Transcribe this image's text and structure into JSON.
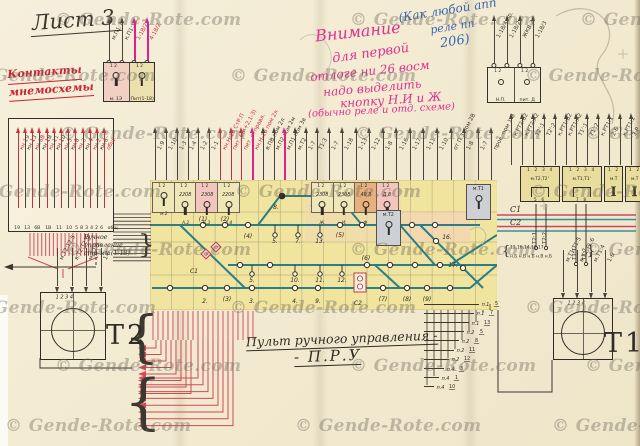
{
  "watermark": {
    "text": "© Gende-Rote.com",
    "color": "#6e6860"
  },
  "sheet": {
    "title": "Лист 3"
  },
  "colors": {
    "paper": "#f3ebd2",
    "ink": "#2f2b26",
    "red_ink": "#cc2232",
    "magenta_pen": "#e0308f",
    "blue_pen": "#3a66b5",
    "panel_yellow": "#f0e49e",
    "track_teal": "#2b7e85",
    "wire_red": "#cf4a58"
  },
  "notes": {
    "red_label_line1": "Контакты",
    "red_label_line2": "мнемосхемы",
    "blue_1": "(Как любой апп",
    "blue_2": "реле пп",
    "blue_3": "206)",
    "magenta_1": "Внимание",
    "magenta_2": "для первой",
    "magenta_3": "отлоге ни 26 восм",
    "magenta_4": "надо выделить",
    "magenta_5": "кнопку Н.И и Ж",
    "magenta_6": "(обычно реле и отд. схеме)",
    "caption_left": "Ручное управление стр-ми (1-18)",
    "title_main": "Пульт ручного управления -",
    "title_abbr": "- П.Р.У"
  },
  "top_left_box": {
    "cells": [
      {
        "label": "м. 1Э"
      },
      {
        "label": "Пит(1-18)"
      }
    ],
    "pins": "1   2",
    "wires": [
      {
        "label": "м.П1:7"
      },
      {
        "label": "к.П1:13"
      },
      {
        "label": "1-18/2",
        "red": true,
        "hot": true
      },
      {
        "label": "4-18/2",
        "red": true,
        "hot": true
      }
    ]
  },
  "np_box": {
    "cells": [
      {
        "label": "Н.П."
      },
      {
        "label": "пит. Д"
      }
    ],
    "pins": "1   2",
    "wires": [
      {
        "label": "1-18/4 пр."
      },
      {
        "label": "1-18/2"
      },
      {
        "label": "ЖКВ:2"
      },
      {
        "label": "1-18/3"
      }
    ]
  },
  "left_block": {
    "wires": [
      {
        "label": "кн.19",
        "red": true
      },
      {
        "label": "кн.13"
      },
      {
        "label": "кн.6В",
        "red": true
      },
      {
        "label": "кн.1В"
      },
      {
        "label": "кн.11",
        "red": true
      },
      {
        "label": "кн.10"
      },
      {
        "label": "кн.5",
        "red": true
      },
      {
        "label": "кн.8"
      },
      {
        "label": "кн.3",
        "red": true
      },
      {
        "label": "кн.4"
      },
      {
        "label": "кн.2",
        "red": true
      },
      {
        "label": "кн.6"
      },
      {
        "label": "общ.",
        "red": true
      }
    ],
    "pins": [
      "19",
      "13",
      "6В",
      "1В",
      "11",
      "10",
      "5",
      "8",
      "3",
      "4",
      "2",
      "6",
      "общ"
    ]
  },
  "panel_wires_left": [
    {
      "label": "1-9"
    },
    {
      "label": "1-10"
    },
    {
      "label": "1-3"
    },
    {
      "label": "1-4"
    },
    {
      "label": "1-2"
    },
    {
      "label": "1-1"
    },
    {
      "label": "кн.Н:18 СтР.П",
      "red": true
    },
    {
      "label": "пит. 6(и+2,1-3)",
      "red": true
    },
    {
      "label": "пит. отправл.",
      "red": true
    },
    {
      "label": "кн.Н-18 пом 2л",
      "red": true,
      "hot": true
    },
    {
      "label": "в.ПВ пом 2л"
    },
    {
      "label": "м.П2 пом 2м"
    },
    {
      "label": "м.П1 пом 3в",
      "hot": true
    },
    {
      "label": "м.Т2"
    },
    {
      "label": "1-7"
    },
    {
      "label": "Т1:3"
    }
  ],
  "panel_wires_right": [
    {
      "label": "1-7"
    },
    {
      "label": "1-18"
    },
    {
      "label": "1-13"
    },
    {
      "label": "1-12"
    },
    {
      "label": "1-8"
    },
    {
      "label": "1-16"
    },
    {
      "label": "1-17"
    },
    {
      "label": "1-11"
    },
    {
      "label": "1-10"
    },
    {
      "label": "от П.3 пом 2В"
    },
    {
      "label": "1-8"
    },
    {
      "label": "1-7"
    },
    {
      "label": "пров. пом 1-В"
    }
  ],
  "right_wires": [
    {
      "label": "к.РТ2:В2"
    },
    {
      "label": "к.РТ2:А2"
    },
    {
      "label": "Т2':1"
    },
    {
      "label": "Т2':2"
    },
    {
      "label": "к.РТ1:В2"
    },
    {
      "label": "к.РТ1:А2"
    },
    {
      "label": "Т1':1"
    },
    {
      "label": "Т1':2"
    },
    {
      "label": "к.РТ1:1"
    },
    {
      "label": "2-Б"
    },
    {
      "label": "к.РТ1:2"
    },
    {
      "label": "3-Р"
    }
  ],
  "right_boxes": [
    {
      "label": "м.Т2,Т2'",
      "sym": "bracket",
      "pins_top": "1 2 3 4",
      "pins_bottom": "5 6",
      "w": 38
    },
    {
      "label": "м.Т1,Т1'",
      "sym": "bracket",
      "pins_top": "1 2 3 4",
      "pins_bottom": "7 8",
      "w": 38
    },
    {
      "label": "м.Т",
      "sym": "coil",
      "pins_top": "1 2",
      "pins_bottom": "",
      "w": 17
    },
    {
      "label": "м.Т",
      "sym": "coil",
      "pins_top": "1 2",
      "pins_bottom": "",
      "w": 17
    }
  ],
  "c_lines": {
    "c1": "С1",
    "c2": "С2",
    "v_labels": [
      "Т2:1",
      "Т2:2",
      "Т1:1",
      "Т1:2"
    ]
  },
  "terminal_bracket": {
    "top": "12,16,14,18,17",
    "bottom": "н.Б н.В н.Б н.В н.Б"
  },
  "t2": {
    "label": "Т2",
    "pins": "1   2   3   4",
    "wires": [
      {
        "label": "м.Т2:Т2:5"
      },
      {
        "label": "в.Т2:Т2:6"
      },
      {
        "label": "м.Т2:3"
      },
      {
        "label": "1-Б"
      }
    ]
  },
  "t1": {
    "label": "Т1",
    "pins": "1   2   3   4",
    "wires": [
      {
        "label": "м.Т1:Т1:5"
      },
      {
        "label": "в.Т1:Т1:6"
      },
      {
        "label": "м.Т1:4"
      },
      {
        "label": "1-Б"
      }
    ]
  },
  "ladder": [
    {
      "t": "п.1",
      "n": "5"
    },
    {
      "t": "п.1",
      "n": "7"
    },
    {
      "t": "п.1",
      "n": "13"
    },
    {
      "t": "п.2",
      "n": "5"
    },
    {
      "t": "п.2",
      "n": "8"
    },
    {
      "t": "п.2",
      "n": "11"
    },
    {
      "t": "п.2",
      "n": "12"
    },
    {
      "t": "п.4",
      "n": "3"
    },
    {
      "t": "п.4",
      "n": "1"
    },
    {
      "t": "п.4",
      "n": "10"
    }
  ],
  "panel": {
    "key_cells": [
      {
        "num": "",
        "sub": "м.2"
      },
      {
        "num": "2208",
        "sub": "А.2"
      },
      {
        "num": "2308",
        "sub": "Б.3",
        "tint": "pink"
      },
      {
        "num": "2208",
        "sub": "А.4"
      },
      {
        "num": "2308",
        "sub": "Ж."
      },
      {
        "num": "2308",
        "sub": "И."
      },
      {
        "num": "49.8",
        "sub": "Ф",
        "tint": "orange"
      },
      {
        "num": "Д.8",
        "sub": "уп.В",
        "tint": "pink"
      }
    ],
    "gray_cells": [
      {
        "label": "м.Т2"
      },
      {
        "label": "м.Т1"
      }
    ],
    "c1": "С1",
    "c2": "С2",
    "lamp_labels": [
      "(1)",
      "(2)",
      "(4)",
      "5.",
      "7.",
      "13.",
      "(5)",
      "8.",
      "14.",
      "5.",
      "10.",
      "11.",
      "12.",
      "(6)",
      "2.",
      "(3)",
      "3.",
      "4.",
      "9.",
      "(7)",
      "(8)",
      "(9)",
      "16.",
      "17."
    ]
  }
}
